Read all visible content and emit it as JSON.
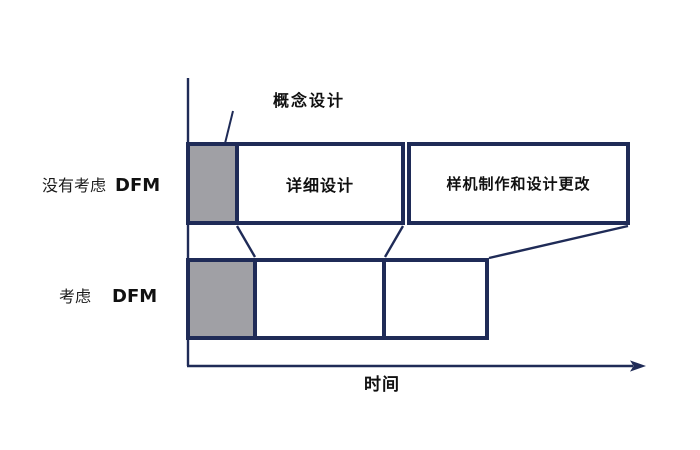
{
  "diagram": {
    "title_semantic": "DFM timeline comparison",
    "annotation_concept": "概念设计",
    "axis_time_label": "时间",
    "rows": [
      {
        "label_cn": "没有考虑",
        "label_acronym": "DFM",
        "boxes": [
          {
            "name": "concept-design",
            "label": "",
            "fill": "gray"
          },
          {
            "name": "detailed-design",
            "label": "详细设计",
            "fill": "white"
          },
          {
            "name": "prototype-and-design-changes",
            "label": "样机制作和设计更改",
            "fill": "white"
          }
        ]
      },
      {
        "label_cn": "考虑",
        "label_acronym": "DFM",
        "boxes": [
          {
            "name": "concept-design",
            "label": "",
            "fill": "gray"
          },
          {
            "name": "detailed-design",
            "label": "",
            "fill": "white"
          },
          {
            "name": "prototype-and-design-changes",
            "label": "",
            "fill": "white"
          }
        ]
      }
    ],
    "colors": {
      "border_navy": "#1f2b57",
      "gray_fill": "#a0a0a5",
      "background": "#ffffff",
      "text": "#111111"
    }
  }
}
